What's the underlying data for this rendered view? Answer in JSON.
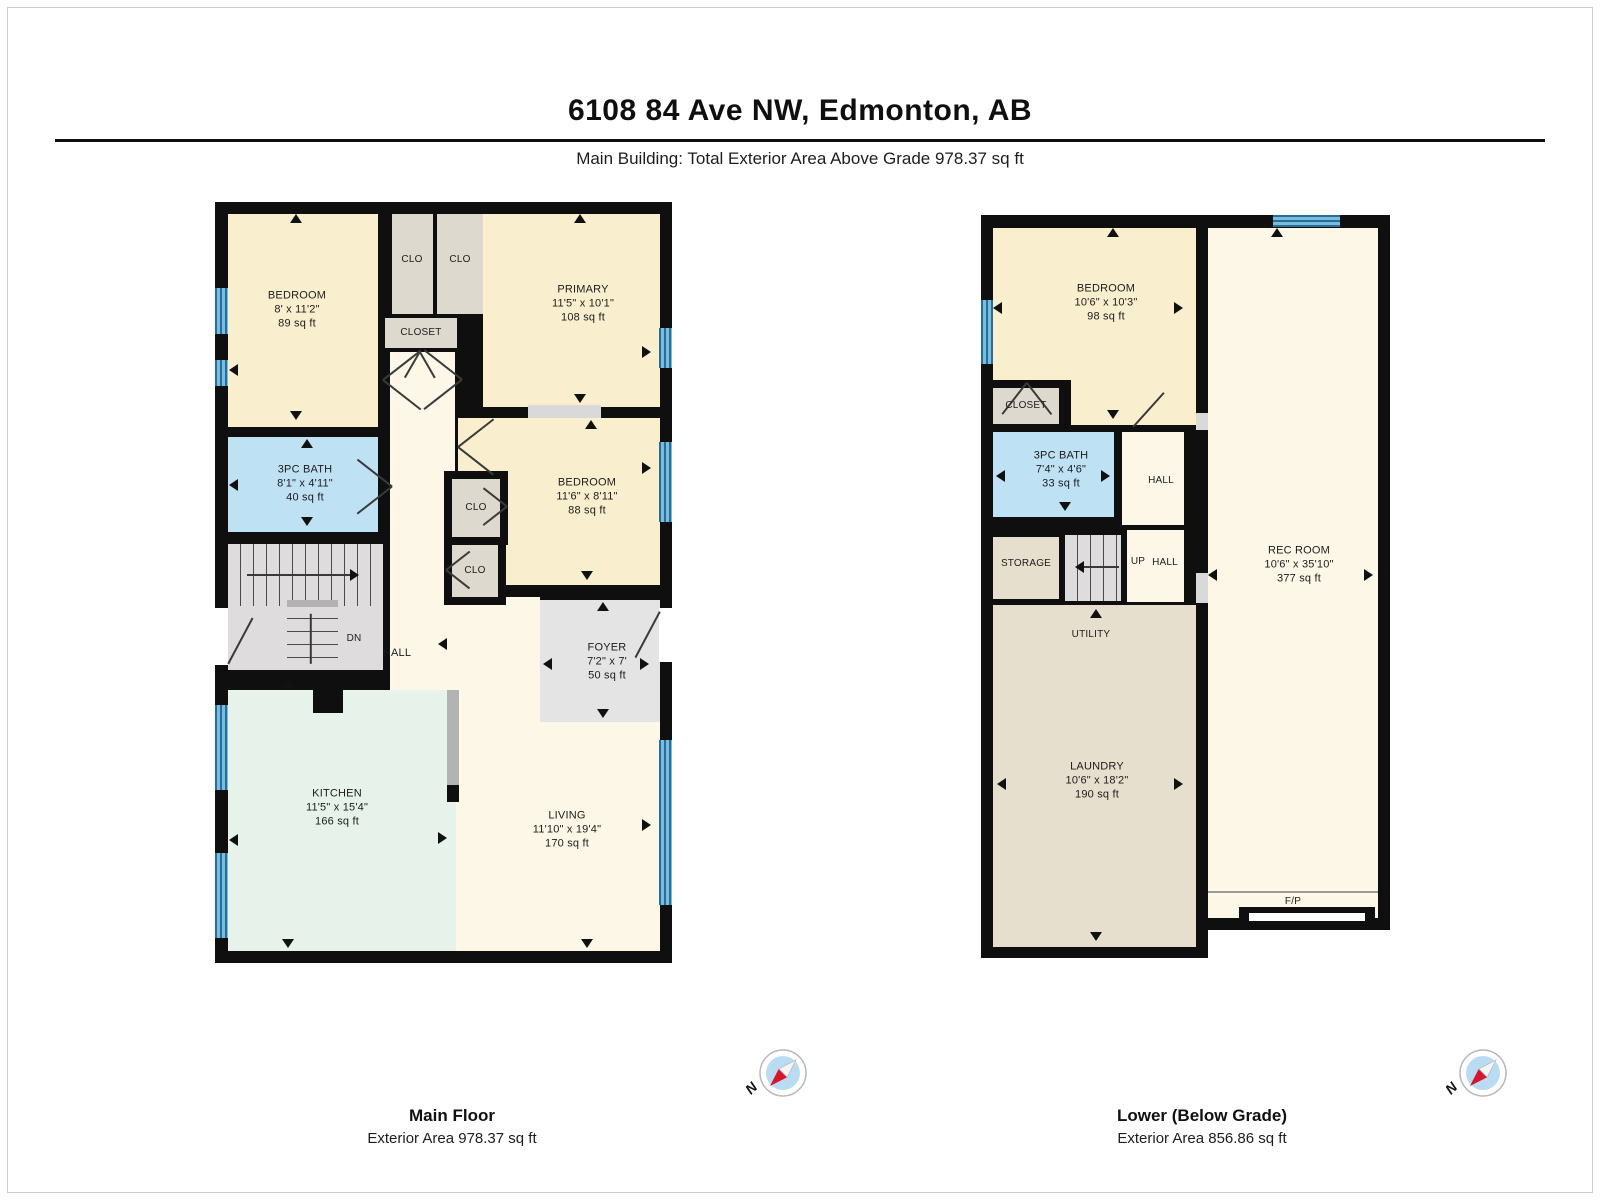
{
  "header": {
    "title": "6108 84 Ave NW, Edmonton, AB",
    "subtitle": "Main Building: Total Exterior Area Above Grade 978.37 sq ft"
  },
  "compass": {
    "n": "N"
  },
  "colors": {
    "wall": "#0f0f0f",
    "cream": "#f9efcf",
    "cream2": "#fcf7e6",
    "closet": "#ded9ce",
    "bath": "#bfe1f4",
    "mint": "#e7f2ea",
    "gray": "#e4e4e4",
    "tan": "#e7dfcd",
    "stairs": "#dedcdc",
    "sill": "#d9d9d9",
    "landing": "#b3b3b3",
    "white": "#ffffff",
    "fpline": "#999999",
    "window": "#79bce2",
    "windowdark": "#2b6c94",
    "line": "#3a3a3a",
    "text": "#1c1c1c"
  },
  "floors": [
    {
      "id": "main-floor",
      "x": 215,
      "y": 202,
      "w": 457,
      "h": 761,
      "caption": {
        "title": "Main Floor",
        "area": "Exterior Area 978.37 sq ft"
      },
      "silhouette": [
        {
          "x": 0,
          "y": 0,
          "w": 457,
          "h": 761
        }
      ],
      "rooms": [
        {
          "name": "bedroom-1",
          "x": 13,
          "y": 12,
          "w": 150,
          "h": 213,
          "fill": "cream",
          "label": [
            "BEDROOM",
            "8' x 11'2\"",
            "89 sq ft"
          ],
          "lx": 82,
          "ly": 108
        },
        {
          "name": "closet-1",
          "x": 177,
          "y": 12,
          "w": 41,
          "h": 100,
          "fill": "closet",
          "label": [
            "CLO"
          ],
          "lx": 197,
          "ly": 58,
          "fs": 10
        },
        {
          "name": "closet-2",
          "x": 222,
          "y": 12,
          "w": 46,
          "h": 100,
          "fill": "closet",
          "label": [
            "CLO"
          ],
          "lx": 245,
          "ly": 58,
          "fs": 10
        },
        {
          "name": "closet-hall",
          "x": 170,
          "y": 116,
          "w": 72,
          "h": 30,
          "fill": "closet",
          "label": [
            "CLOSET"
          ],
          "lx": 206,
          "ly": 131,
          "fs": 10
        },
        {
          "name": "primary",
          "x": 268,
          "y": 12,
          "w": 177,
          "h": 193,
          "fill": "cream",
          "label": [
            "PRIMARY",
            "11'5\" x 10'1\"",
            "108 sq ft"
          ],
          "lx": 368,
          "ly": 102
        },
        {
          "name": "hall-corridor",
          "x": 175,
          "y": 150,
          "w": 65,
          "h": 245,
          "fill": "cream2"
        },
        {
          "name": "hall-lower",
          "x": 175,
          "y": 395,
          "w": 150,
          "h": 97,
          "fill": "cream2"
        },
        {
          "name": "bath",
          "x": 13,
          "y": 235,
          "w": 150,
          "h": 95,
          "fill": "bath",
          "label": [
            "3PC BATH",
            "8'1\" x 4'11\"",
            "40 sq ft"
          ],
          "lx": 90,
          "ly": 282
        },
        {
          "name": "bedroom-2",
          "x": 243,
          "y": 216,
          "w": 202,
          "h": 167,
          "fill": "cream",
          "label": [
            "BEDROOM",
            "11'6\" x 8'11\"",
            "88 sq ft"
          ],
          "lx": 372,
          "ly": 295
        },
        {
          "name": "kitchen",
          "x": 13,
          "y": 488,
          "w": 228,
          "h": 261,
          "fill": "mint",
          "label": [
            "KITCHEN",
            "11'5\" x 15'4\"",
            "166 sq ft"
          ],
          "lx": 122,
          "ly": 606
        },
        {
          "name": "living",
          "x": 241,
          "y": 398,
          "w": 204,
          "h": 351,
          "fill": "cream2",
          "label": [
            "LIVING",
            "11'10\" x 19'4\"",
            "170 sq ft"
          ],
          "lx": 352,
          "ly": 628
        },
        {
          "name": "foyer",
          "x": 325,
          "y": 398,
          "w": 120,
          "h": 122,
          "fill": "gray",
          "label": [
            "FOYER",
            "7'2\" x 7'",
            "50 sq ft"
          ],
          "lx": 392,
          "ly": 460
        }
      ],
      "stairs": [
        {
          "x": 13,
          "y": 342,
          "w": 155,
          "h": 62,
          "t": "v"
        },
        {
          "x": 13,
          "y": 404,
          "w": 155,
          "h": 64,
          "t": "plain"
        },
        {
          "x": 72,
          "y": 404,
          "w": 51,
          "h": 64,
          "t": "h"
        }
      ],
      "overlays": [
        {
          "x": 229,
          "y": 269,
          "w": 64,
          "h": 74,
          "f": "wall"
        },
        {
          "x": 237,
          "y": 277,
          "w": 48,
          "h": 58,
          "f": "closet"
        },
        {
          "x": 229,
          "y": 335,
          "w": 62,
          "h": 68,
          "f": "wall"
        },
        {
          "x": 237,
          "y": 343,
          "w": 46,
          "h": 52,
          "f": "closet"
        },
        {
          "x": 313,
          "y": 203,
          "w": 73,
          "h": 13,
          "f": "sill"
        },
        {
          "x": 98,
          "y": 479,
          "w": 30,
          "h": 32,
          "f": "wall"
        },
        {
          "x": 232,
          "y": 488,
          "w": 12,
          "h": 95,
          "f": "landing"
        },
        {
          "x": 232,
          "y": 583,
          "w": 12,
          "h": 17,
          "f": "wall"
        },
        {
          "x": 0,
          "y": 406,
          "w": 13,
          "h": 57,
          "f": "white"
        },
        {
          "x": 444,
          "y": 406,
          "w": 13,
          "h": 54,
          "f": "white"
        },
        {
          "x": 72,
          "y": 398,
          "w": 51,
          "h": 7,
          "f": "landing"
        }
      ],
      "windows": [
        {
          "x": 0,
          "y": 86,
          "w": 13,
          "h": 46,
          "o": "v"
        },
        {
          "x": 0,
          "y": 158,
          "w": 13,
          "h": 26,
          "o": "v"
        },
        {
          "x": 0,
          "y": 503,
          "w": 13,
          "h": 85,
          "o": "v"
        },
        {
          "x": 0,
          "y": 651,
          "w": 13,
          "h": 85,
          "o": "v"
        },
        {
          "x": 444,
          "y": 126,
          "w": 13,
          "h": 40,
          "o": "v"
        },
        {
          "x": 444,
          "y": 240,
          "w": 13,
          "h": 80,
          "o": "v"
        },
        {
          "x": 444,
          "y": 538,
          "w": 13,
          "h": 165,
          "o": "v"
        }
      ],
      "lines": [
        {
          "x": 168,
          "y": 178,
          "len": 48,
          "a": -38
        },
        {
          "x": 168,
          "y": 178,
          "len": 48,
          "a": 38
        },
        {
          "x": 247,
          "y": 178,
          "len": 48,
          "a": 142
        },
        {
          "x": 247,
          "y": 178,
          "len": 48,
          "a": -142
        },
        {
          "x": 205,
          "y": 150,
          "len": 30,
          "a": 60
        },
        {
          "x": 205,
          "y": 150,
          "len": 30,
          "a": 120
        },
        {
          "x": 177,
          "y": 285,
          "len": 44,
          "a": -142
        },
        {
          "x": 177,
          "y": 285,
          "len": 44,
          "a": 142
        },
        {
          "x": 243,
          "y": 245,
          "len": 45,
          "a": -38
        },
        {
          "x": 243,
          "y": 245,
          "len": 45,
          "a": 38
        },
        {
          "x": 292,
          "y": 305,
          "len": 30,
          "a": -142
        },
        {
          "x": 292,
          "y": 305,
          "len": 30,
          "a": 142
        },
        {
          "x": 231,
          "y": 368,
          "len": 30,
          "a": -38
        },
        {
          "x": 231,
          "y": 368,
          "len": 30,
          "a": 38
        },
        {
          "x": 445,
          "y": 410,
          "len": 52,
          "a": 118
        },
        {
          "x": 13,
          "y": 462,
          "len": 52,
          "a": -62
        },
        {
          "x": 32,
          "y": 373,
          "len": 106,
          "a": 0
        },
        {
          "x": 96,
          "y": 412,
          "len": 50,
          "a": 90
        }
      ],
      "arrows": [
        {
          "x": 81,
          "y": 16,
          "d": "up"
        },
        {
          "x": 365,
          "y": 16,
          "d": "up"
        },
        {
          "x": 18,
          "y": 168,
          "d": "left"
        },
        {
          "x": 432,
          "y": 150,
          "d": "right"
        },
        {
          "x": 81,
          "y": 214,
          "d": "down"
        },
        {
          "x": 365,
          "y": 197,
          "d": "down"
        },
        {
          "x": 376,
          "y": 222,
          "d": "up"
        },
        {
          "x": 92,
          "y": 241,
          "d": "up"
        },
        {
          "x": 18,
          "y": 283,
          "d": "left"
        },
        {
          "x": 92,
          "y": 320,
          "d": "down"
        },
        {
          "x": 432,
          "y": 266,
          "d": "right"
        },
        {
          "x": 372,
          "y": 374,
          "d": "down"
        },
        {
          "x": 227,
          "y": 442,
          "d": "left"
        },
        {
          "x": 388,
          "y": 404,
          "d": "up"
        },
        {
          "x": 332,
          "y": 462,
          "d": "left"
        },
        {
          "x": 430,
          "y": 462,
          "d": "right"
        },
        {
          "x": 388,
          "y": 512,
          "d": "down"
        },
        {
          "x": 73,
          "y": 481,
          "d": "up"
        },
        {
          "x": 18,
          "y": 638,
          "d": "left"
        },
        {
          "x": 228,
          "y": 636,
          "d": "right"
        },
        {
          "x": 432,
          "y": 623,
          "d": "right"
        },
        {
          "x": 73,
          "y": 742,
          "d": "down"
        },
        {
          "x": 372,
          "y": 742,
          "d": "down"
        },
        {
          "x": 140,
          "y": 373,
          "d": "right"
        }
      ],
      "texts": [
        {
          "x": 139,
          "y": 437,
          "t": "DN",
          "fs": 10
        },
        {
          "x": 182,
          "y": 452,
          "t": "HALL",
          "fs": 11
        },
        {
          "x": 261,
          "y": 306,
          "t": "CLO",
          "fs": 10
        },
        {
          "x": 260,
          "y": 369,
          "t": "CLO",
          "fs": 10
        }
      ]
    },
    {
      "id": "lower-floor",
      "x": 981,
      "y": 215,
      "w": 409,
      "h": 743,
      "caption": {
        "title": "Lower (Below Grade)",
        "area": "Exterior Area 856.86 sq ft"
      },
      "silhouette": [
        {
          "x": 0,
          "y": 0,
          "w": 227,
          "h": 743
        },
        {
          "x": 215,
          "y": 0,
          "w": 194,
          "h": 715
        }
      ],
      "rooms": [
        {
          "name": "bedroom",
          "x": 12,
          "y": 13,
          "w": 203,
          "h": 197,
          "fill": "cream",
          "label": [
            "BEDROOM",
            "10'6\" x 10'3\"",
            "98 sq ft"
          ],
          "lx": 125,
          "ly": 88
        },
        {
          "name": "bath",
          "x": 12,
          "y": 217,
          "w": 121,
          "h": 85,
          "fill": "bath",
          "label": [
            "3PC BATH",
            "7'4\" x 4'6\"",
            "33 sq ft"
          ],
          "lx": 80,
          "ly": 255
        },
        {
          "name": "hall-upper",
          "x": 141,
          "y": 217,
          "w": 62,
          "h": 93,
          "fill": "cream2",
          "label": [
            "HALL"
          ],
          "lx": 180,
          "ly": 266,
          "fs": 10
        },
        {
          "name": "storage",
          "x": 12,
          "y": 322,
          "w": 66,
          "h": 62,
          "fill": "tan",
          "label": [
            "STORAGE"
          ],
          "lx": 45,
          "ly": 349,
          "fs": 10
        },
        {
          "name": "up-hall",
          "x": 146,
          "y": 315,
          "w": 57,
          "h": 72,
          "fill": "cream2"
        },
        {
          "name": "utility-laundry",
          "x": 12,
          "y": 390,
          "w": 203,
          "h": 342,
          "fill": "tan",
          "label": [
            "LAUNDRY",
            "10'6\" x 18'2\"",
            "190 sq ft"
          ],
          "lx": 116,
          "ly": 566
        },
        {
          "name": "rec-room",
          "x": 227,
          "y": 13,
          "w": 170,
          "h": 690,
          "fill": "cream2",
          "label": [
            "REC ROOM",
            "10'6\" x 35'10\"",
            "377 sq ft"
          ],
          "lx": 318,
          "ly": 350
        }
      ],
      "stairs": [
        {
          "x": 84,
          "y": 320,
          "w": 56,
          "h": 66,
          "t": "v"
        }
      ],
      "overlays": [
        {
          "x": 4,
          "y": 165,
          "w": 86,
          "h": 52,
          "f": "wall"
        },
        {
          "x": 12,
          "y": 173,
          "w": 66,
          "h": 36,
          "f": "closet"
        },
        {
          "x": 215,
          "y": 198,
          "w": 12,
          "h": 17,
          "f": "sill"
        },
        {
          "x": 215,
          "y": 358,
          "w": 12,
          "h": 30,
          "f": "sill"
        },
        {
          "x": 227,
          "y": 676,
          "w": 170,
          "h": 2,
          "f": "fpline"
        },
        {
          "x": 258,
          "y": 692,
          "w": 136,
          "h": 21,
          "f": "wall"
        },
        {
          "x": 268,
          "y": 698,
          "w": 116,
          "h": 8,
          "f": "white"
        }
      ],
      "windows": [
        {
          "x": 292,
          "y": 0,
          "w": 67,
          "h": 12,
          "o": "h"
        },
        {
          "x": 0,
          "y": 85,
          "w": 12,
          "h": 64,
          "o": "v"
        }
      ],
      "lines": [
        {
          "x": 46,
          "y": 168,
          "len": 40,
          "a": 52
        },
        {
          "x": 46,
          "y": 168,
          "len": 40,
          "a": 128
        },
        {
          "x": 152,
          "y": 212,
          "len": 46,
          "a": -48
        },
        {
          "x": 98,
          "y": 352,
          "len": 40,
          "a": 0
        }
      ],
      "arrows": [
        {
          "x": 132,
          "y": 17,
          "d": "up"
        },
        {
          "x": 296,
          "y": 17,
          "d": "up"
        },
        {
          "x": 16,
          "y": 93,
          "d": "left"
        },
        {
          "x": 198,
          "y": 93,
          "d": "right"
        },
        {
          "x": 132,
          "y": 200,
          "d": "down"
        },
        {
          "x": 19,
          "y": 261,
          "d": "left"
        },
        {
          "x": 125,
          "y": 261,
          "d": "right"
        },
        {
          "x": 84,
          "y": 292,
          "d": "down"
        },
        {
          "x": 115,
          "y": 398,
          "d": "up"
        },
        {
          "x": 231,
          "y": 360,
          "d": "left"
        },
        {
          "x": 388,
          "y": 360,
          "d": "right"
        },
        {
          "x": 20,
          "y": 569,
          "d": "left"
        },
        {
          "x": 198,
          "y": 569,
          "d": "right"
        },
        {
          "x": 115,
          "y": 722,
          "d": "down"
        },
        {
          "x": 98,
          "y": 352,
          "d": "left"
        }
      ],
      "texts": [
        {
          "x": 45,
          "y": 191,
          "t": "CLOSET",
          "fs": 10
        },
        {
          "x": 157,
          "y": 347,
          "t": "UP",
          "fs": 10
        },
        {
          "x": 184,
          "y": 348,
          "t": "HALL",
          "fs": 10
        },
        {
          "x": 110,
          "y": 420,
          "t": "UTILITY",
          "fs": 10
        },
        {
          "x": 312,
          "y": 687,
          "t": "F/P",
          "fs": 10
        }
      ]
    }
  ]
}
